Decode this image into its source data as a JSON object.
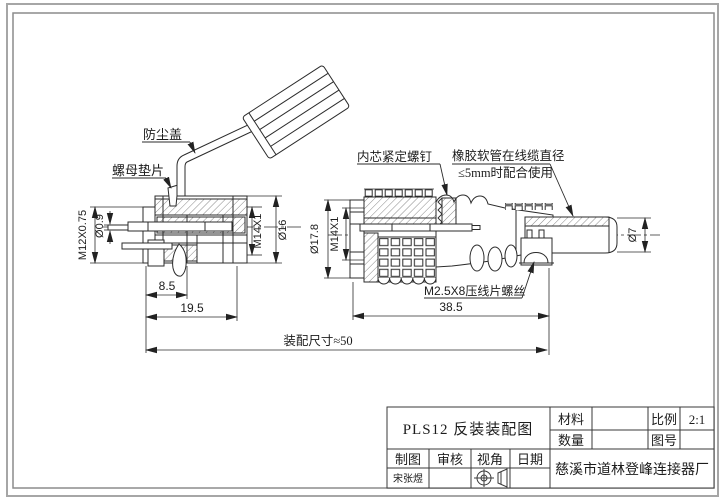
{
  "drawing": {
    "labels": {
      "dust_cover": "防尘盖",
      "nut_washer": "螺母垫片",
      "core_set_screw": "内芯紧定螺钉",
      "rubber_hose_line1": "橡胶软管在线缆直径",
      "rubber_hose_line2": "≤5mm时配合使用",
      "crimp_screw": "M2.5X8压线片螺丝"
    },
    "dims": {
      "left_thread": "M12X0.75",
      "pin_diameter": "Ø0.9",
      "left_coupling_thread": "M14X1",
      "left_body_diameter": "Ø16",
      "left_len_front": "8.5",
      "left_len_total": "19.5",
      "right_flange_diameter": "Ø17.8",
      "right_coupling_thread": "M14X1",
      "right_len_total": "38.5",
      "assembly_length": "装配尺寸≈50",
      "boot_diameter": "Ø7"
    }
  },
  "title_block": {
    "title": "PLS12  反装装配图",
    "material_label": "材料",
    "quantity_label": "数量",
    "scale_label": "比例",
    "scale_value": "2:1",
    "drawing_no_label": "图号",
    "drawn_label": "制图",
    "checked_label": "审核",
    "view_angle_label": "视角",
    "date_label": "日期",
    "drawn_by": "宋张煜",
    "company": "慈溪市道林登峰连接器厂"
  }
}
